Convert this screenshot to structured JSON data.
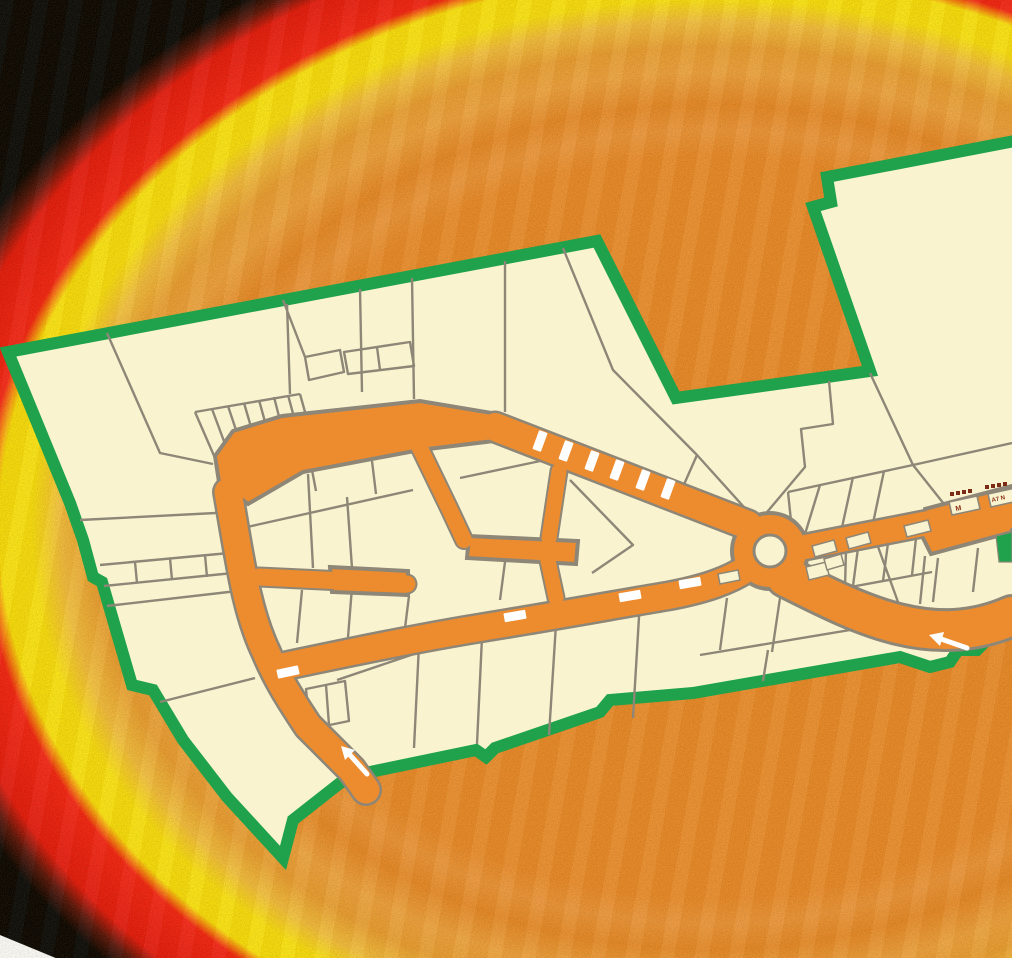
{
  "map": {
    "kind": "parcel-plat-overlay-on-heat-imagery",
    "colors": {
      "boundary_green": "#1fa24b",
      "parcel_fill": "#f9f4cf",
      "parcel_line": "#8e8677",
      "road_orange": "#ec8c2f",
      "road_marking": "#ffffff",
      "background_orange": "#ee8c2a",
      "band_yellow": "#ffe70d",
      "band_red": "#f92012",
      "corner_black": "#000000",
      "corner_white": "#ffffff",
      "tree_marker": "#7c2b15",
      "label_red": "#8a2c12"
    },
    "buildings": [
      {
        "label": "M"
      },
      {
        "label": "A7 N"
      }
    ],
    "road_markings": {
      "lane_dashes_northeast_road": 6,
      "lane_dashes_bottom_road": 4,
      "direction_arrows": 2,
      "median_islands": 3,
      "roundabouts": 1
    }
  }
}
